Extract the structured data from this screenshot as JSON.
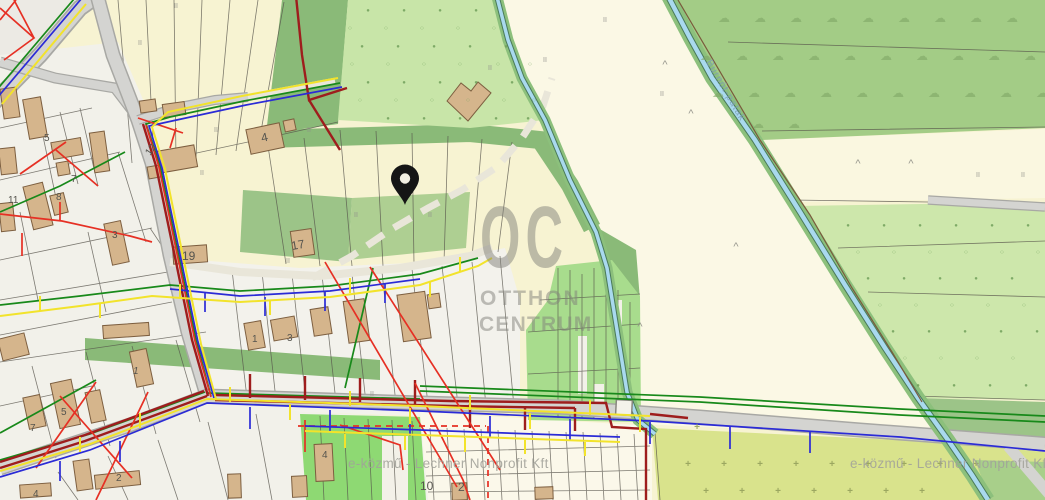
{
  "map": {
    "watermark": {
      "oc": "OC",
      "line2": "OTTHON",
      "line3": "CENTRUM"
    },
    "attribution": "e-közmű - Lechner Nonprofit Kft",
    "stream_label": "Burnót-patak",
    "marker": {
      "x": 405,
      "y": 205
    },
    "colors": {
      "base": "#f7f3d2",
      "corner_gray": "#eceae4",
      "residential": "#f2f1ea",
      "white_band": "#f3f2ec",
      "field_cream": "#fbf8e5",
      "field_pale": "#faf7e0",
      "road_fill": "#d4d4d1",
      "road_casing": "#a8a8a4",
      "track": "#e9e6d9",
      "dark_green": "#8aba78",
      "mid_green": "#9cc488",
      "light_green": "#aecf92",
      "dotted_green": "#c8e5a8",
      "orchard_green": "#cde7ab",
      "cloud_green": "#a3cc86",
      "allotment_green": "#a8dc8d",
      "bottom_green": "#8ed973",
      "olive": "#d9e38c",
      "olive2": "#a8cf8a",
      "mesh_cream": "#fbf8ea",
      "stream_bank": "#8cc07c",
      "stream_casing": "#4a7a5a",
      "stream_water": "#a9d9ee",
      "cadastral_brown": "#7a5a3c",
      "parcel_line": "#55524a",
      "building_fill": "#d5b58c",
      "building_stroke": "#7d5f40",
      "util_red": "#e63024",
      "util_darkred": "#9e1d1d",
      "util_green": "#18891a",
      "util_blue": "#2b2bd6",
      "util_yellow": "#f2e32b",
      "pin": "#151515",
      "pin_hole": "#f2efe2",
      "watermark": "#82827b",
      "attribution": "#a2a29a",
      "label_gray": "#55544e",
      "stream_label": "#7e9cb4",
      "culvert_fill": "#f4f2ea",
      "culvert_stroke": "#88877f",
      "white_patch": "#f3f1e8"
    },
    "glyphs": {
      "dot_filled": {
        "ch": "●",
        "size": 6,
        "color": "#71a05b",
        "op": 0.85
      },
      "dot_open": {
        "ch": "○",
        "size": 6.5,
        "color": "#79a863",
        "op": 0.9
      },
      "cloud": {
        "ch": "☁",
        "size": 12,
        "color": "#7fa766",
        "op": 0.6
      },
      "grass": {
        "ch": "II",
        "size": 7,
        "color": "#90908a",
        "op": 0.9
      },
      "scrub": {
        "ch": "^",
        "size": 11,
        "color": "#8e8e86",
        "op": 0.9
      },
      "cross": {
        "ch": "+",
        "size": 10,
        "color": "#95a15c",
        "op": 0.9,
        "bold": true
      }
    },
    "symbol_fields": [
      {
        "glyph": "dot_filled",
        "rows": [
          {
            "y": 12,
            "xs": [
              368,
              404,
              440,
              476
            ]
          },
          {
            "y": 48,
            "xs": [
              362,
              398,
              434,
              470,
              506
            ]
          },
          {
            "y": 84,
            "xs": [
              368,
              404,
              440,
              476,
              512
            ]
          },
          {
            "y": 120,
            "xs": [
              388,
              424,
              460,
              496,
              528
            ]
          },
          {
            "y": 227,
            "xs": [
              848,
              884,
              920,
              956,
              992,
              1028
            ]
          },
          {
            "y": 280,
            "xs": [
              868,
              904,
              940,
              976,
              1012
            ]
          },
          {
            "y": 333,
            "xs": [
              893,
              929,
              965,
              1001,
              1037
            ]
          },
          {
            "y": 387,
            "xs": [
              918,
              954,
              990,
              1026
            ]
          }
        ]
      },
      {
        "glyph": "dot_open",
        "rows": [
          {
            "y": 30,
            "xs": [
              350,
              386,
              422,
              458,
              494
            ]
          },
          {
            "y": 66,
            "xs": [
              352,
              388,
              424,
              460,
              498,
              530
            ]
          },
          {
            "y": 102,
            "xs": [
              360,
              396,
              432,
              468,
              504,
              534
            ]
          },
          {
            "y": 254,
            "xs": [
              858,
              894,
              930,
              966,
              1002,
              1038
            ]
          },
          {
            "y": 307,
            "xs": [
              880,
              916,
              952,
              988,
              1024
            ]
          },
          {
            "y": 360,
            "xs": [
              905,
              941,
              977,
              1013
            ]
          }
        ]
      },
      {
        "glyph": "cloud",
        "rows": [
          {
            "y": 22,
            "xs": [
              724,
              760,
              796,
              832,
              868,
              904,
              940,
              976,
              1012
            ]
          },
          {
            "y": 60,
            "xs": [
              706,
              742,
              778,
              814,
              850,
              886,
              922,
              958,
              994,
              1030
            ]
          },
          {
            "y": 97,
            "xs": [
              718,
              754,
              790,
              826,
              862,
              898,
              934,
              970,
              1006,
              1042
            ]
          },
          {
            "y": 128,
            "xs": [
              758,
              794
            ]
          }
        ]
      },
      {
        "glyph": "cross",
        "rows": [
          {
            "y": 430,
            "xs": [
              697
            ]
          },
          {
            "y": 467,
            "xs": [
              688,
              724,
              760,
              796,
              832,
              868,
              904,
              940,
              976
            ]
          },
          {
            "y": 494,
            "xs": [
              706,
              742,
              778,
              814,
              850,
              886,
              922
            ]
          }
        ]
      },
      {
        "glyph": "grass",
        "rows": [
          {
            "y": 45,
            "xs": [
              140
            ]
          },
          {
            "y": 8,
            "xs": [
              176
            ]
          },
          {
            "y": 132,
            "xs": [
              216,
              309
            ]
          },
          {
            "y": 175,
            "xs": [
              202
            ]
          },
          {
            "y": 263,
            "xs": [
              288
            ]
          },
          {
            "y": 217,
            "xs": [
              356,
              430
            ]
          },
          {
            "y": 70,
            "xs": [
              490
            ]
          },
          {
            "y": 62,
            "xs": [
              545
            ]
          },
          {
            "y": 22,
            "xs": [
              605
            ]
          },
          {
            "y": 96,
            "xs": [
              662
            ]
          },
          {
            "y": 177,
            "xs": [
              978,
              1023
            ]
          },
          {
            "y": 396,
            "xs": [
              372
            ]
          }
        ]
      },
      {
        "glyph": "scrub",
        "rows": [
          {
            "y": 68,
            "xs": [
              665
            ]
          },
          {
            "y": 117,
            "xs": [
              691
            ]
          },
          {
            "y": 167,
            "xs": [
              858,
              911
            ]
          },
          {
            "y": 250,
            "xs": [
              736
            ]
          },
          {
            "y": 330,
            "xs": [
              640
            ]
          }
        ]
      }
    ],
    "house_numbers": [
      {
        "text": "5",
        "x": 44,
        "y": 141
      },
      {
        "text": "7",
        "x": 71,
        "y": 182
      },
      {
        "text": "8",
        "x": 56,
        "y": 200
      },
      {
        "text": "11",
        "x": 8,
        "y": 203
      },
      {
        "text": "3",
        "x": 112,
        "y": 238
      },
      {
        "text": "12",
        "x": 150,
        "y": 156,
        "rot": -55
      },
      {
        "text": "4",
        "x": 262,
        "y": 142,
        "rot": -12,
        "size": 12
      },
      {
        "text": "19",
        "x": 182,
        "y": 260,
        "size": 12
      },
      {
        "text": "17",
        "x": 292,
        "y": 250,
        "rot": -10,
        "size": 12
      },
      {
        "text": "1",
        "x": 133,
        "y": 374,
        "italic": true
      },
      {
        "text": "1",
        "x": 252,
        "y": 342
      },
      {
        "text": "3",
        "x": 287,
        "y": 341
      },
      {
        "text": "5",
        "x": 61,
        "y": 415
      },
      {
        "text": "7",
        "x": 30,
        "y": 431
      },
      {
        "text": "2",
        "x": 116,
        "y": 481
      },
      {
        "text": "4",
        "x": 33,
        "y": 497
      },
      {
        "text": "4",
        "x": 322,
        "y": 458
      },
      {
        "text": "10",
        "x": 420,
        "y": 490,
        "size": 12
      },
      {
        "text": "2",
        "x": 458,
        "y": 491,
        "size": 12
      }
    ]
  }
}
